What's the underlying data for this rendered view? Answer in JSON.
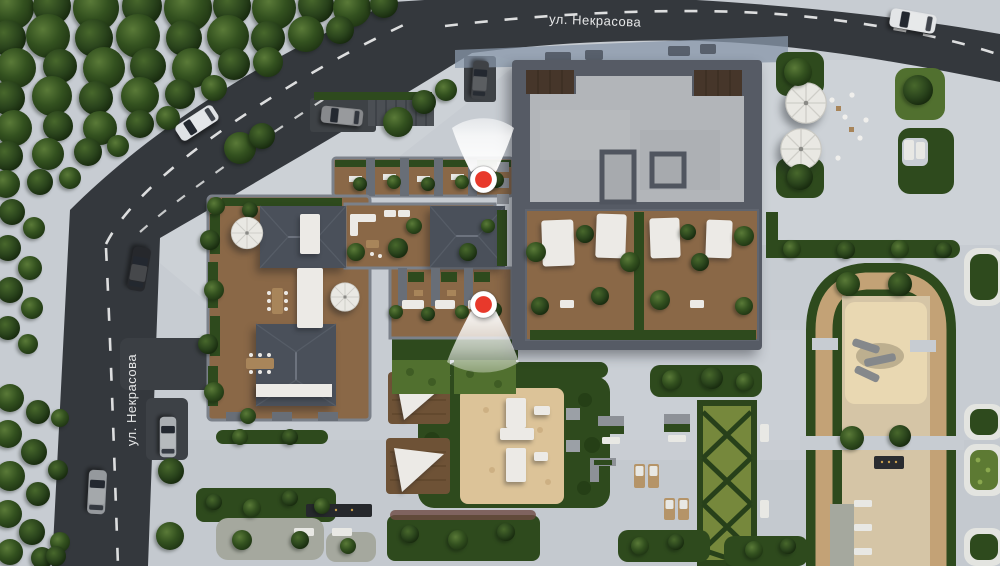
{
  "scene": {
    "type": "aerial-masterplan-render",
    "streets": {
      "top": {
        "label": "ул. Некрасова"
      },
      "left": {
        "label": "ул. Некрасова"
      }
    },
    "viewpoints": [
      {
        "id": "viewpoint-1",
        "direction": "up"
      },
      {
        "id": "viewpoint-2",
        "direction": "down"
      }
    ],
    "colors": {
      "marker_red": "#e8392b",
      "marker_ring": "#ffffff",
      "road": "#34383d",
      "pavement": "#c7ccd2",
      "forest_green": "#375425",
      "hedge_green": "#2e4a1d",
      "lawn_green": "#51702f",
      "deck_wood": "#8a6847",
      "roof_slate": "#4a505a",
      "roof_concrete": "#b2b5b9",
      "sand": "#ddc398",
      "canopy_white": "#eceae6"
    }
  }
}
